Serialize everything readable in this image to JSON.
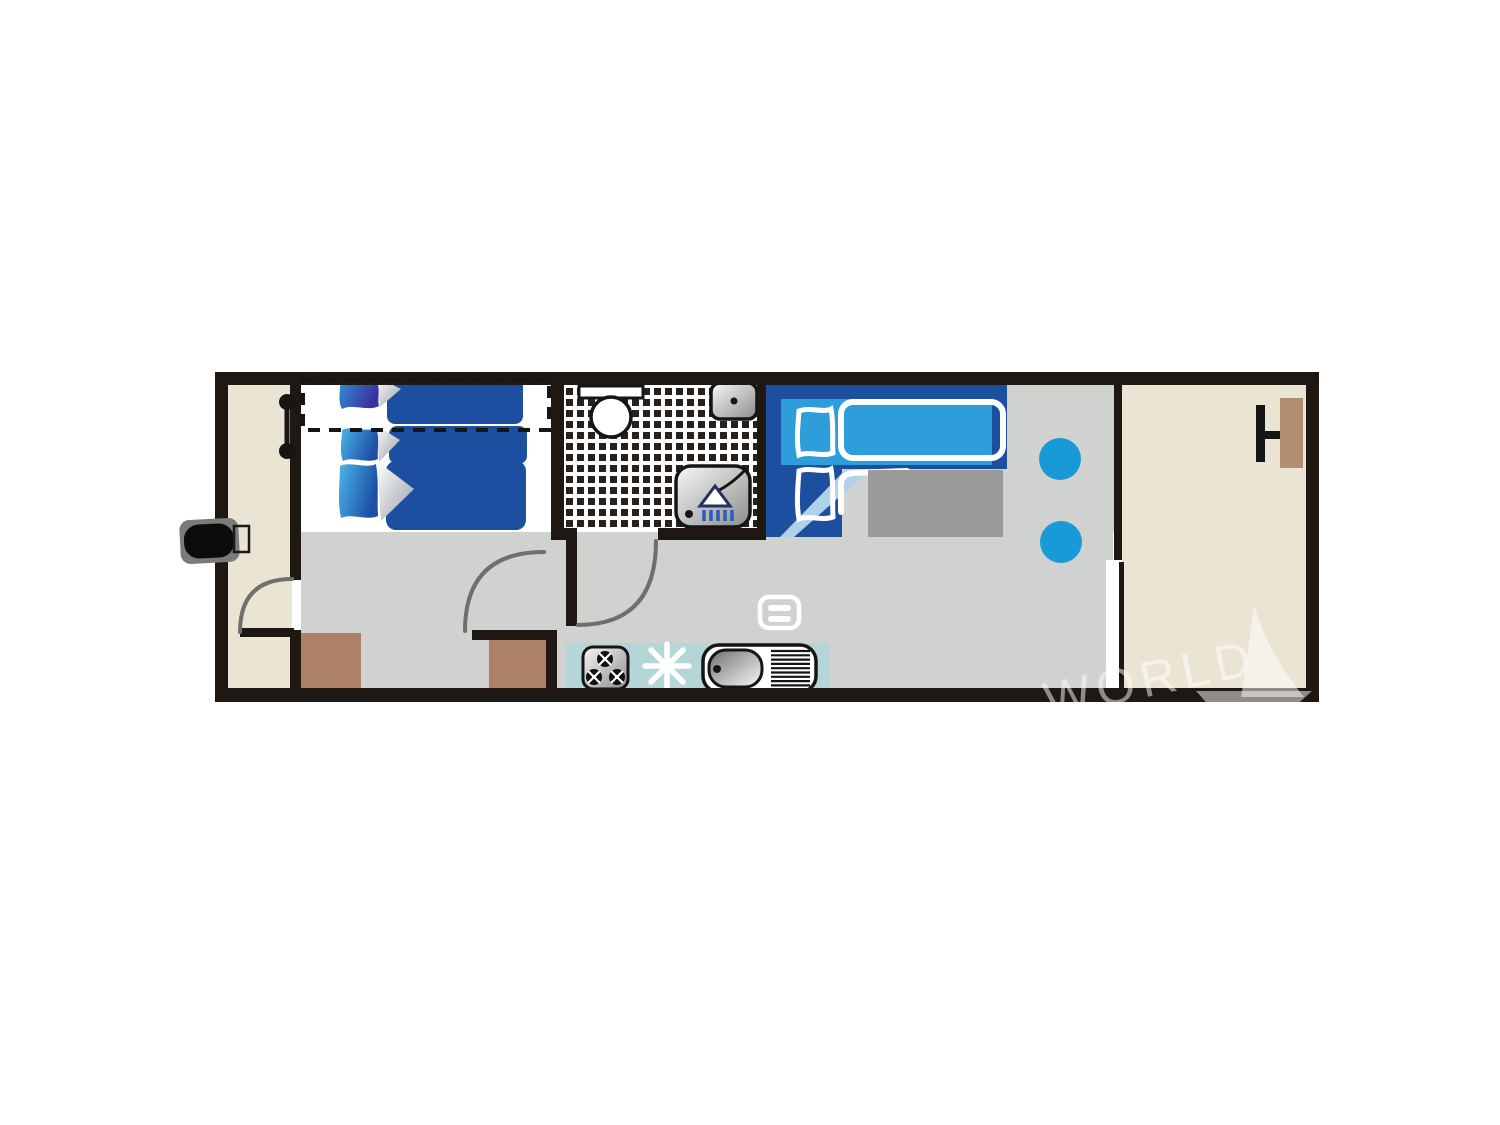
{
  "meta": {
    "description": "Floor plan of a compact mobile home / houseboat unit"
  },
  "watermark": {
    "text": "WORLD"
  },
  "colors": {
    "wall": "#1e1712",
    "floor_beige": "#eae4d2",
    "floor_gray": "#cfd2cf",
    "floor_white": "#ffffff",
    "tile_black": "#26211c",
    "counter_teal": "#b5d6d8",
    "cabinet_brown": "#ac8166",
    "table_brown": "#b28d72",
    "bed_blue_dark": "#1d4fa0",
    "bed_blue_light": "#2d9ed9",
    "bed_blue_pale": "#aed2e8",
    "pillow_purple_dark": "#3c2fa0",
    "stool_blue": "#189ad6",
    "table_gray": "#9b9b9b",
    "shower_stripe_blue": "#2a5cb8",
    "arc_gray": "#6f6f6f",
    "step_gray": "#7b7b78",
    "step_black": "#0c0c0c",
    "line_black": "#151515",
    "watermark_white": "rgba(255,255,255,0.5)"
  }
}
